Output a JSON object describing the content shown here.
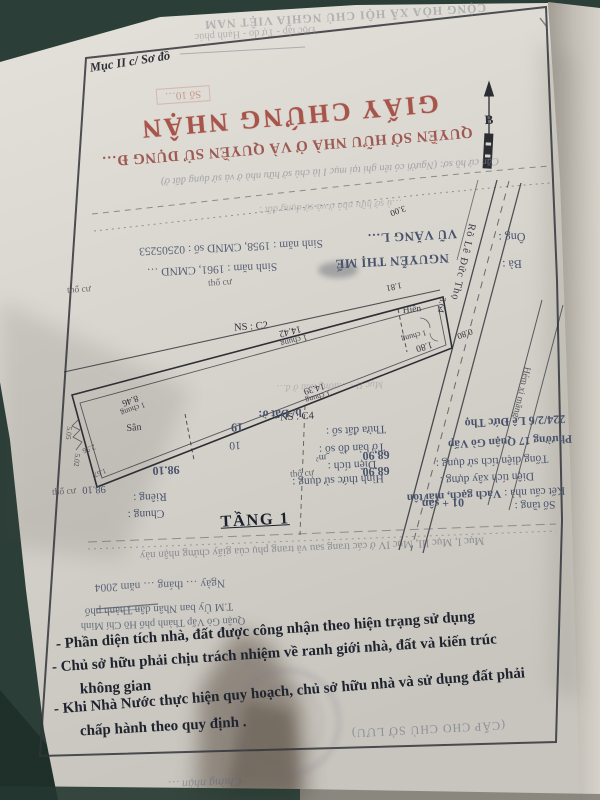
{
  "meta": {
    "section_label": "Mục II c/ Sơ đồ"
  },
  "colors": {
    "background_teal": "#2b3e38",
    "paper": "#d8d5ce",
    "title_red": "#9c382e",
    "form_ink_blue": "#49536b",
    "print_black": "#20242f"
  },
  "header": {
    "national_line1": "CỘNG HÒA XÃ HỘI CHỦ NGHĨA VIỆT NAM",
    "national_line2": "Độc lập - Tự do - Hạnh phúc",
    "number_stamp": "Số 10…",
    "title": "GIẤY CHỨNG NHẬN",
    "subtitle": "QUYỀN SỞ HỮU NHÀ Ở VÀ QUYỀN SỬ DỤNG Đ…",
    "note": "Căn cứ hồ sơ: (Người có tên ghi tại mục I là chủ sở hữu nhà ở và sử dụng đất ở)",
    "road_note": "…ủ sở hữu nhà ở và sử dụng đất :"
  },
  "owners": {
    "husband_label": "Ông :",
    "husband_name": "VŨ VĂNG L…",
    "husband_info": "Sinh năm : 1958, CMND số : 02505253",
    "wife_label": "Bà :",
    "wife_name": "NGUYỄN THỊ MẾ",
    "wife_info": "Sinh năm : 1961, CMND …"
  },
  "map": {
    "north_label": "B",
    "street_name": "Rõ Lê Đức Thọ",
    "alley_label": "Hẻm xi măng",
    "plot_code_1": "NS : C2",
    "plot_code_2": "NS : C4",
    "yard_label": "Sân",
    "porch_label": "Hiên",
    "zone_label": "thổ cư",
    "floor_label": "TẦNG 1",
    "diagram_note": "Mục II - …ường nhà ở đ…",
    "measurements": {
      "m_1442": "14.42",
      "m_1439": "14.39",
      "m_846": "8.46",
      "m_180": "1.80",
      "m_181": "1.81",
      "m_364": "3.64",
      "m_300": "3.00",
      "m_080": "0.80",
      "m_505": "5.05",
      "m_256": "2.56",
      "m_167": "1.67",
      "m_502": "5.02",
      "shared_wall": "1 chung"
    }
  },
  "land_form": {
    "section": "b/ Đất ở:",
    "parcel_label": "Thửa đất số :",
    "parcel_value": "19",
    "sheet_label": "Tờ bản đồ số :",
    "sheet_value": "10",
    "area_label": "Diện tích :",
    "area_value": "98.10",
    "area_unit": "m²",
    "usage_label": "Hình thức sử dụng :",
    "private_label": "Riêng :",
    "private_value": "98.10",
    "shared_label": "Chung :"
  },
  "house_form": {
    "address": "224/2/6 Lê Đức Thọ",
    "ward": "Phường 17 Quận Gò Vấp",
    "total_label": "Tổng diện tích sử dụng :",
    "total_value": "68.90",
    "build_label": "Diện tích xây dựng :",
    "build_value": "68.90",
    "structure_label": "Kết cấu nhà :",
    "structure_value": "Vách gạch, mái tôn",
    "floors_label": "Số tầng :",
    "floors_value": "01 + sân"
  },
  "footer": {
    "pages_note": "Mục I, Mục III, Mục IV ở các trang sau và trang phụ của giấy chứng nhận này",
    "date_line": "Ngày … tháng … năm 2004",
    "sign_line1": "T.M Ủy ban Nhân dân Thành phố",
    "sign_line2": "Quận Gò Vấp Thành phố Hồ Chí Minh",
    "copy_note": "(CẤP CHO CHỦ SỞ LƯU)",
    "handwriting": "Chứng nhận …"
  },
  "notes": {
    "line1": "- Phần diện tích nhà, đất được công nhận theo hiện trạng sử dụng",
    "line2": "- Chủ sở hữu phải chịu trách nhiệm về ranh giới nhà, đất và kiến trúc",
    "line3": "không gian",
    "line4": "- Khi Nhà Nước  thực hiện quy hoạch, chủ sở hữu nhà và sử dụng đất phải",
    "line5": "chấp hành theo quy định ."
  }
}
